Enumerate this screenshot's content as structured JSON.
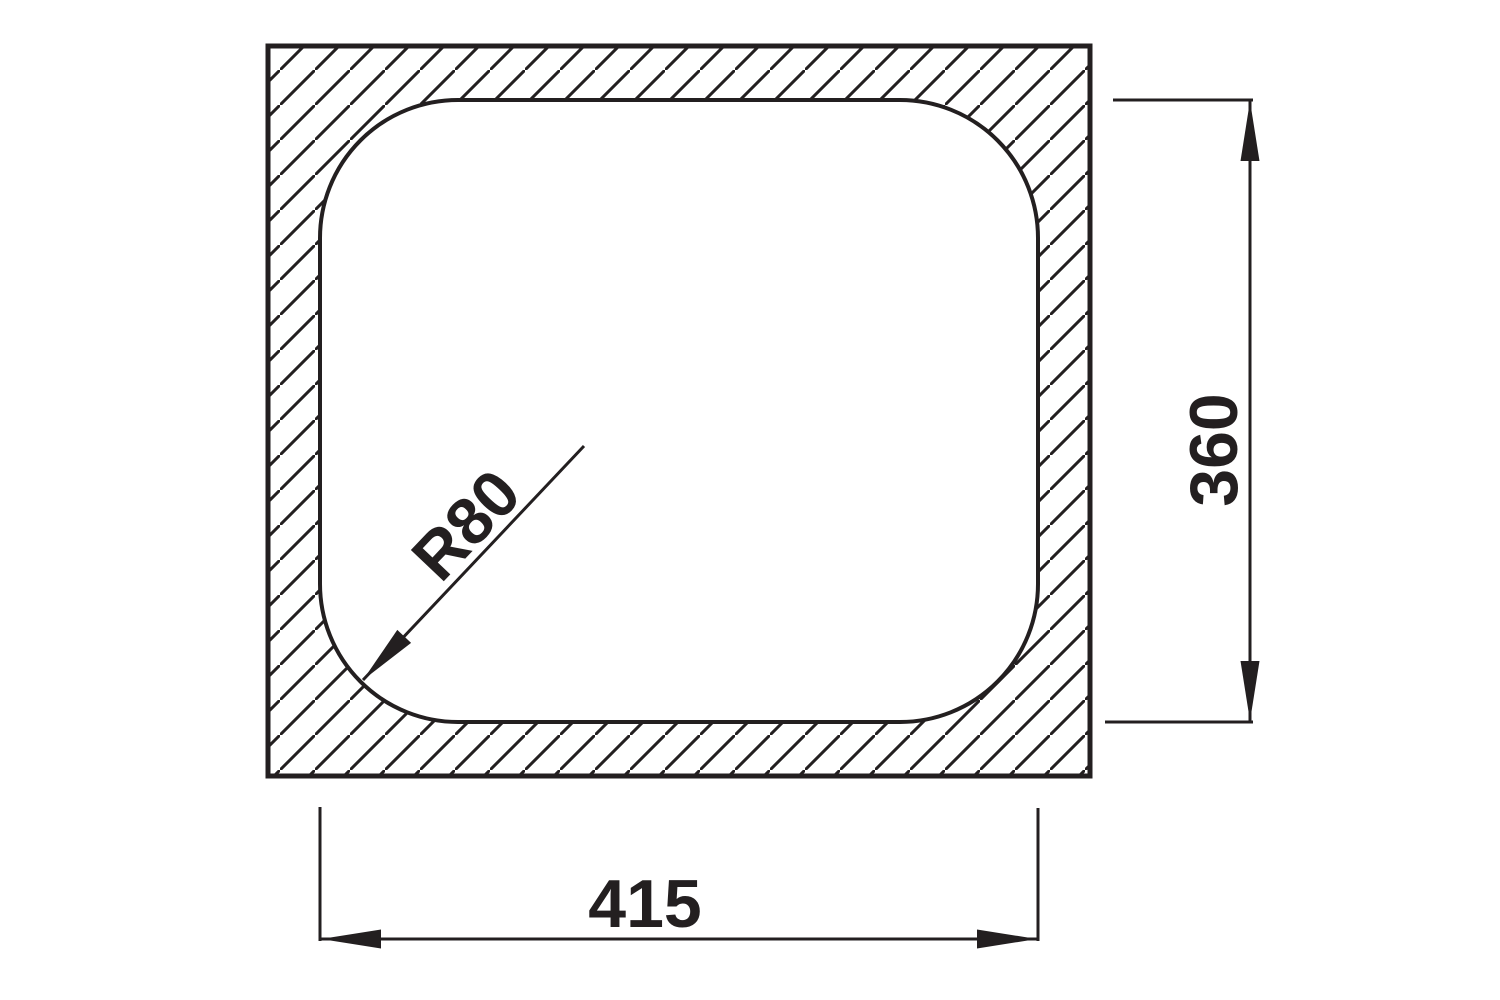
{
  "drawing": {
    "labels": {
      "width": "415",
      "height": "360",
      "corner_radius": "R80"
    },
    "colors": {
      "line": "#231f20",
      "background": "#ffffff"
    }
  }
}
